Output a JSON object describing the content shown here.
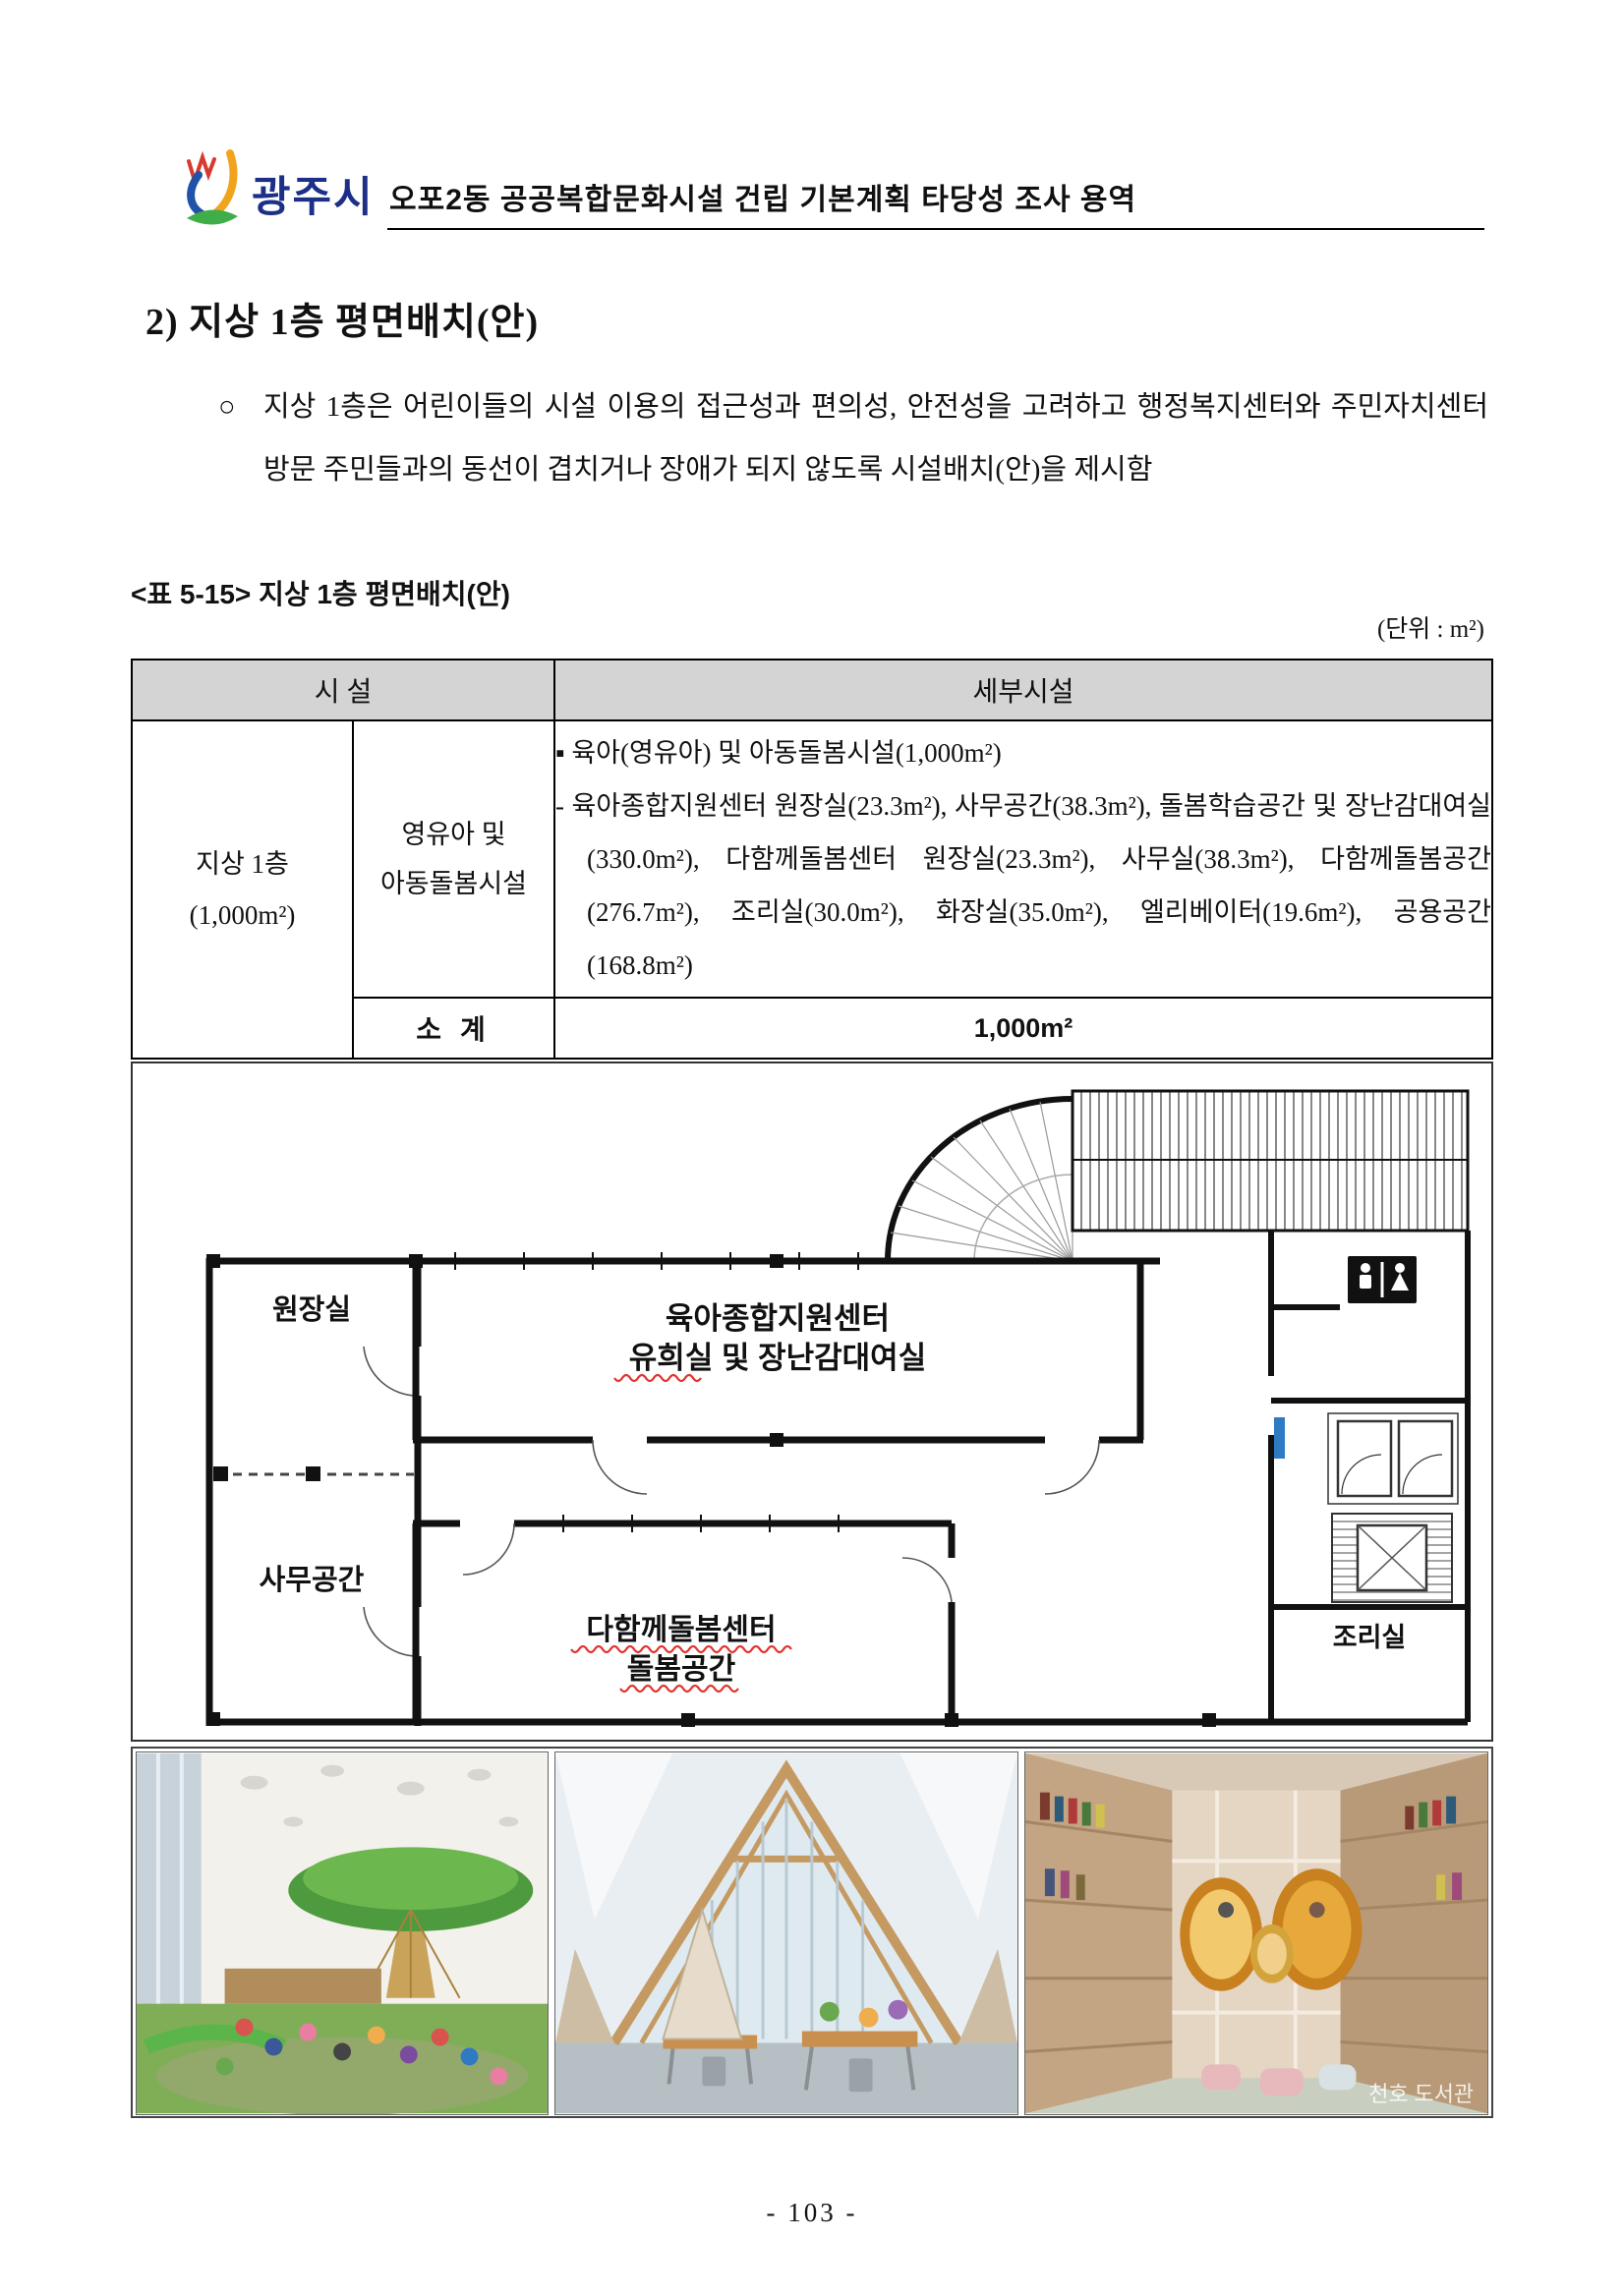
{
  "header": {
    "logo_text": "광주시",
    "title": "오포2동 공공복합문화시설 건립 기본계획 타당성 조사 용역"
  },
  "section": {
    "heading": "2) 지상 1층 평면배치(안)",
    "bullet": "○",
    "paragraph": "지상 1층은 어린이들의 시설 이용의 접근성과 편의성, 안전성을 고려하고 행정복지센터와 주민자치센터 방문 주민들과의 동선이 겹치거나 장애가 되지 않도록 시설배치(안)을 제시함"
  },
  "table": {
    "caption": "<표 5-15> 지상 1층 평면배치(안)",
    "unit": "(단위 : m²)",
    "col_facility": "시 설",
    "col_detail": "세부시설",
    "floor_label": "지상 1층",
    "floor_area": "(1,000m²)",
    "facility_name_l1": "영유아 및",
    "facility_name_l2": "아동돌봄시설",
    "detail_bullet": "▪ 육아(영유아) 및 아동돌봄시설(1,000m²)",
    "detail_item": "- 육아종합지원센터 원장실(23.3m²), 사무공간(38.3m²), 돌봄학습공간 및 장난감대여실(330.0m²), 다함께돌봄센터 원장실(23.3m²), 사무실(38.3m²), 다함께돌봄공간(276.7m²), 조리실(30.0m²), 화장실(35.0m²), 엘리베이터(19.6m²), 공용공간(168.8m²)",
    "subtotal_label": "소 계",
    "subtotal_value": "1,000m²"
  },
  "plan": {
    "director_room": "원장실",
    "office_space": "사무공간",
    "support_line1": "육아종합지원센터",
    "support_line2a": "유희실",
    "support_line2b": " 및 장난감대여실",
    "care_line1": "다함께돌봄센터",
    "care_line2": "돌봄공간",
    "kitchen": "조리실"
  },
  "photos": {
    "watermark": "천호 도서관"
  },
  "footer": {
    "page_number": "- 103 -"
  }
}
